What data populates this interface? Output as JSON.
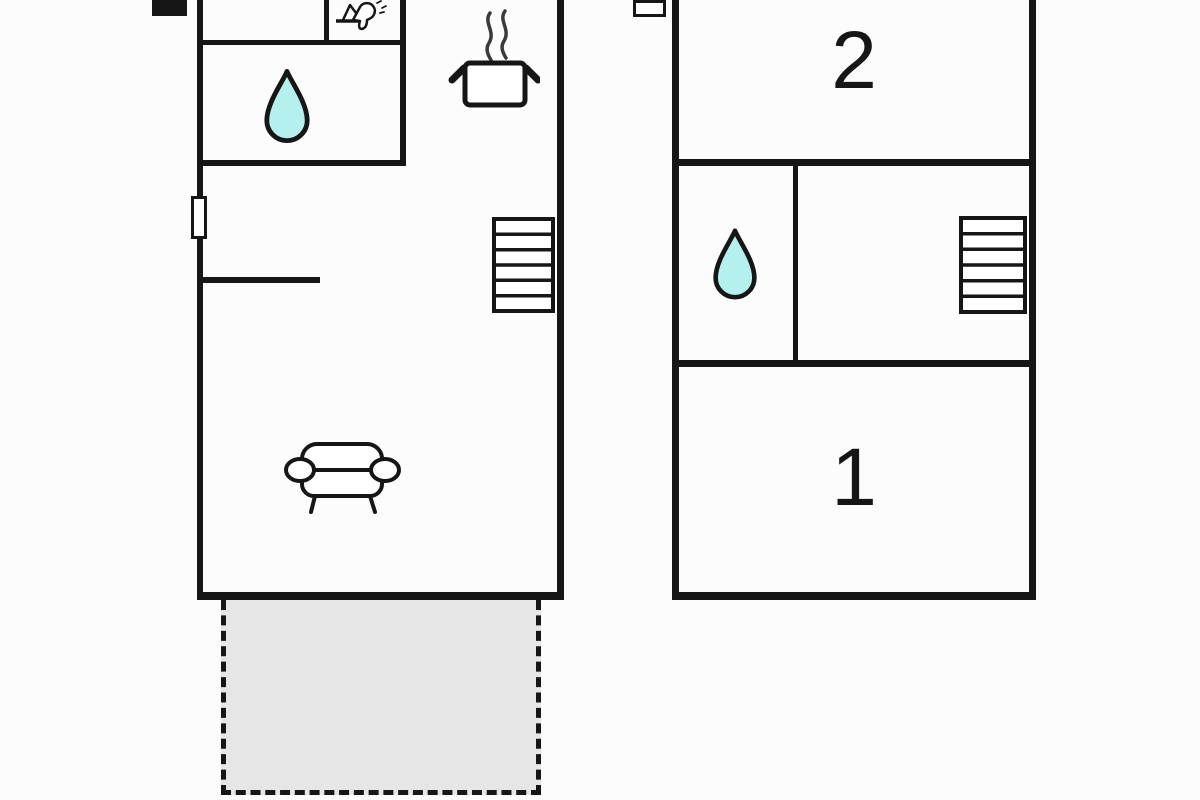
{
  "colors": {
    "wall": "#161616",
    "water_drop": "#b4f0ee",
    "terrace": "#e6e6e6",
    "background": "#fcfcfc"
  },
  "right_unit": {
    "upper_room_label": "2",
    "lower_room_label": "1"
  },
  "icons": [
    "chimney-icon",
    "window-icon",
    "faucet-icon",
    "water-drop-icon",
    "cooking-pot-icon",
    "stairs-icon",
    "sofa-icon"
  ]
}
